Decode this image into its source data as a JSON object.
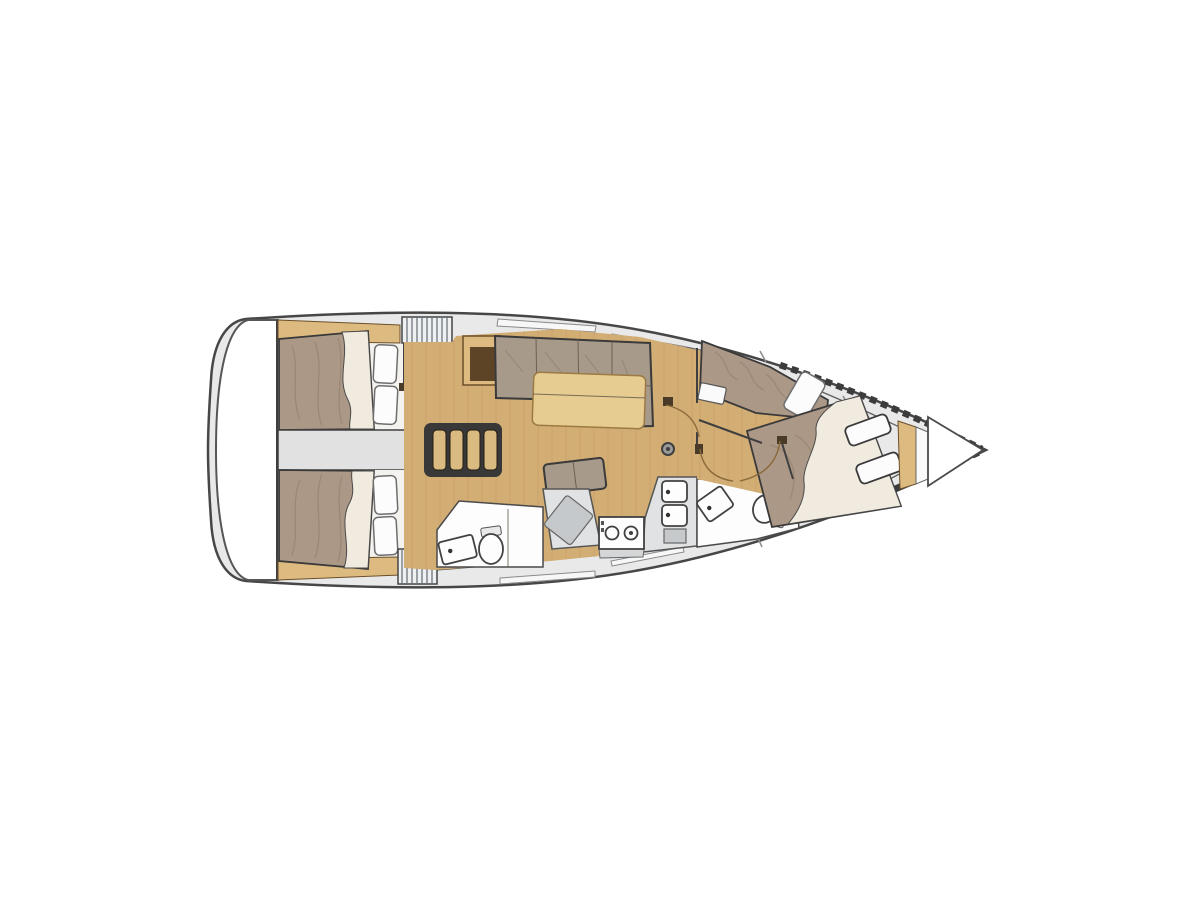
{
  "image": {
    "kind": "yacht-interior-floorplan",
    "orientation": "bow-right",
    "background": "#ffffff"
  },
  "palette": {
    "hull_line": "#474747",
    "deck": "#e9e9e9",
    "transom": "#ffffff",
    "cabin_floor": "#f3f2ee",
    "corridor": "#e1e1e1",
    "wood_floor": "#d2ad74",
    "wood_trim": "#ddbb80",
    "table_wood": "#e7cc92",
    "mattress": "#ac9887",
    "mattress_dark": "#94816e",
    "linen": "#f1ebdf",
    "pillow": "#fcfcfc",
    "counter": "#e0e2e3",
    "counter_dark": "#c6c9cb",
    "fixture_white": "#fdfdfd",
    "stripe_bg": "#eef0f1",
    "stripe_line": "#9aa0a6",
    "stair_frame": "#383838",
    "stair_step": "#d9ba80",
    "cabinet_dark": "#5d4426",
    "door_arc": "#8a6a3a",
    "wall": "#3f3f3f"
  },
  "vessel": {
    "areas": [
      {
        "id": "transom",
        "label": "stern swim platform"
      },
      {
        "id": "aft-cabin-port",
        "label": "aft double cabin port side with berth and pillows"
      },
      {
        "id": "aft-cabin-starboard",
        "label": "aft double cabin starboard side with berth and pillows"
      },
      {
        "id": "engine-compartment",
        "label": "engine compartment between aft cabins"
      },
      {
        "id": "companionway",
        "label": "companionway steps with four treads"
      },
      {
        "id": "saloon",
        "label": "saloon with L-sofa, table, bench and chart cabinet"
      },
      {
        "id": "galley",
        "label": "galley with two-burner stove and double sink"
      },
      {
        "id": "aft-head",
        "label": "aft head with sink, toilet and shower"
      },
      {
        "id": "forward-head",
        "label": "forward head with sink and toilet"
      },
      {
        "id": "forward-cabin",
        "label": "forward cabin with island double berth and side single berth"
      },
      {
        "id": "anchor-locker",
        "label": "anchor locker at bow"
      }
    ],
    "hatches": 2,
    "doors": 6,
    "berths": 4,
    "stove_burners": 2,
    "sink_basins": 2,
    "mast_step": 1
  }
}
